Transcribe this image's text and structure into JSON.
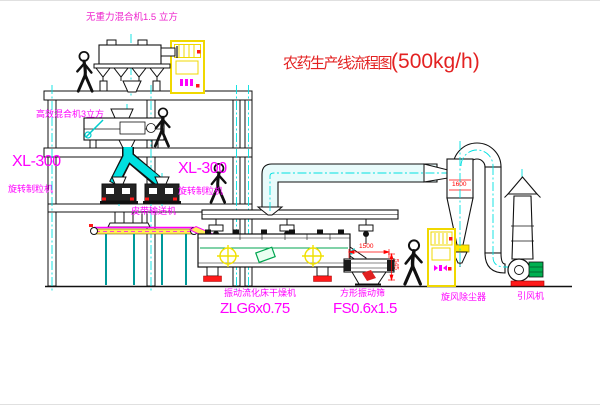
{
  "title": {
    "text_cn": "农药生产线流程图",
    "text_rate": "(500kg/h)"
  },
  "labels": {
    "top_mixer": "无重力混合机1.5 立方",
    "second_mixer": "高效混合机3立方",
    "granulator_left_model": "XL-300",
    "granulator_left_name": "旋转制粒机",
    "granulator_right_model": "XL-300",
    "granulator_right_name": "旋转制粒机",
    "belt_conveyor": "皮带输送机",
    "dryer_name": "振动流化床干燥机",
    "dryer_model": "ZLG6x0.75",
    "screen_name": "方形振动筛",
    "screen_model": "FS0.6x1.5",
    "cyclone": "旋风除尘器",
    "fan": "引风机"
  },
  "dimensions": {
    "screen_length": "1500",
    "screen_height": "545",
    "cyclone_size": "1600"
  },
  "colors": {
    "label_magenta": "#ff00ff",
    "title_red": "#e32222",
    "dimension_red": "#ff0000",
    "centerline_cyan": "#00e0e0",
    "cabinet_yellow": "#ffe800",
    "accent_green": "#00a550"
  }
}
